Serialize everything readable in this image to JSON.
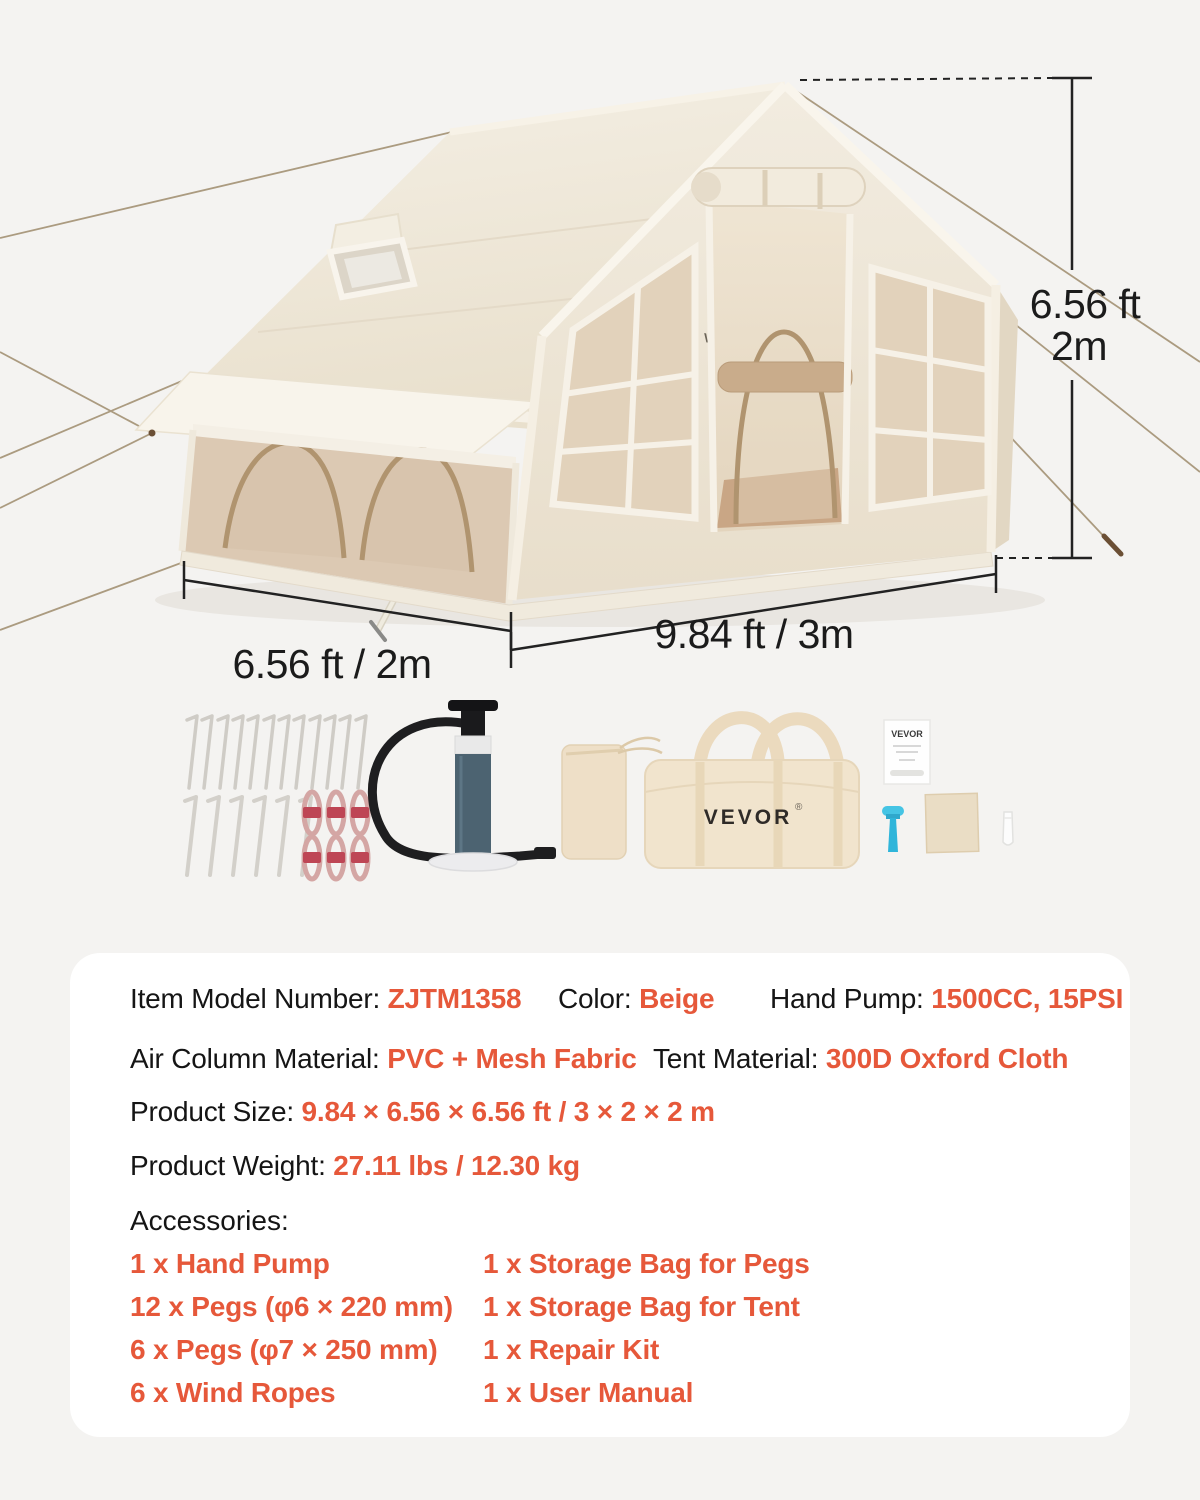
{
  "dims": {
    "height_ft": "6.56 ft",
    "height_m": "2m",
    "side_label": "6.56 ft / 2m",
    "front_label": "9.84 ft / 3m"
  },
  "tent": {
    "logo": "VEVOR"
  },
  "photo": {
    "bag_logo": "VEVOR",
    "reg_mark": "®",
    "manual_logo": "VEVOR"
  },
  "specs": {
    "line1": [
      {
        "label": "Item Model Number: ",
        "value": "ZJTM1358"
      },
      {
        "label": "Color: ",
        "value": "Beige"
      },
      {
        "label": "Hand Pump: ",
        "value": "1500CC, 15PSI"
      }
    ],
    "line2": [
      {
        "label": "Air Column Material: ",
        "value": "PVC + Mesh Fabric"
      },
      {
        "label": "Tent Material: ",
        "value": "300D Oxford Cloth"
      }
    ],
    "line3": {
      "label": "Product Size: ",
      "value": "9.84 × 6.56 × 6.56 ft / 3 × 2 × 2 m"
    },
    "line4": {
      "label": "Product Weight: ",
      "value": "27.11 lbs / 12.30 kg"
    }
  },
  "accessories": {
    "heading": "Accessories:",
    "col1": [
      "1 x Hand Pump",
      "12 x Pegs (φ6 × 220 mm)",
      "6 x Pegs (φ7 × 250 mm)",
      "6 x Wind Ropes"
    ],
    "col2": [
      "1 x Storage Bag for Pegs",
      "1 x Storage Bag for Tent",
      "1 x Repair Kit",
      "1 x User Manual"
    ]
  },
  "colors": {
    "accent": "#E6583A",
    "text": "#151515",
    "page_bg": "#F4F3F1",
    "panel_bg": "#FFFFFF",
    "canvas": "#F0E9DC",
    "mesh": "#DCC9B3"
  }
}
